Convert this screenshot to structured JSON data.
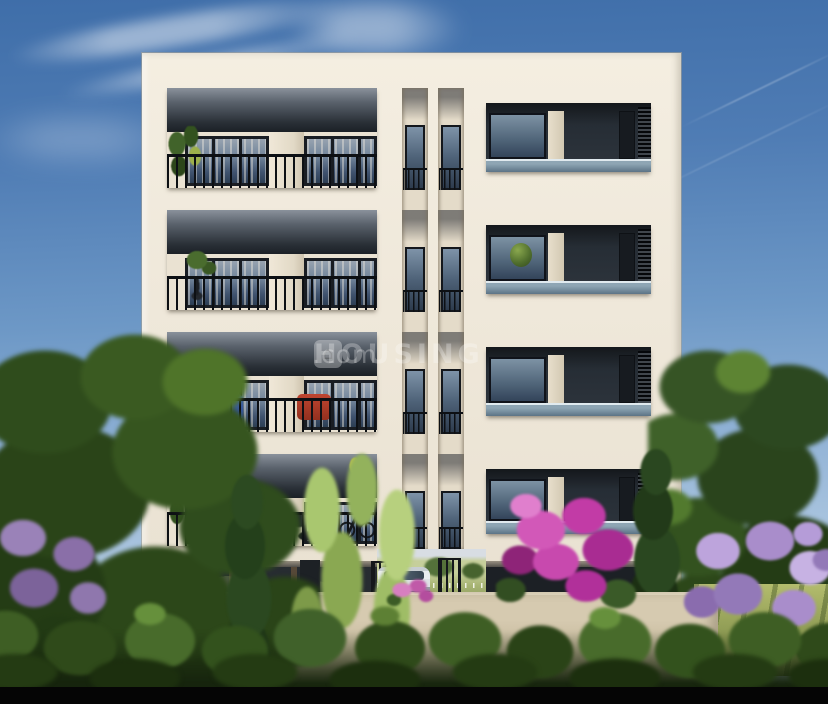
{
  "meta": {
    "title": "apartment-building-exterior-render",
    "type": "3d-architectural-visualization"
  },
  "watermark": {
    "logo_glyph": "⌂",
    "brand": "HOUSING",
    "suffix": ".com"
  },
  "building": {
    "floors": 4,
    "left_wing": "balconies with black metal railings, sliding glass doors, potted plants, blue and red chairs, bicycle",
    "core": "twin vertical slit windows with juliet railings",
    "right_wing": "balconies with glass parapets, AC louver panels, plant on ledge",
    "ground": "open stilt parking with white car and entrance gates"
  },
  "landscape": {
    "left": "large tree, lavender shrub, cypress, bamboo plants",
    "right": "trees, magenta bougainvillea, lilac shrubs, sunlit lawn",
    "front": "beige compound wall with hedge row"
  },
  "sky": {
    "clouds": "wispy cirrus upper-left",
    "contrails": "two faint jet trails upper-right"
  },
  "colors": {
    "sky_top": "#3f6ea9",
    "sky_horizon": "#c3d5e8",
    "facade_cream": "#efe8da",
    "slab": "#ddd4c2",
    "ceiling_shadow": "#23272d",
    "railing_black": "#0d1014",
    "door_glass": "#5c7188",
    "glass_parapet": "#9eb4c2",
    "compound_wall": "#d0c4ab",
    "hedge_green": "#3b5a22",
    "bougainvillea": "#c23ba6",
    "lilac": "#b59cd8",
    "car_white": "#eaedef",
    "bottom_bar": "#050505"
  }
}
